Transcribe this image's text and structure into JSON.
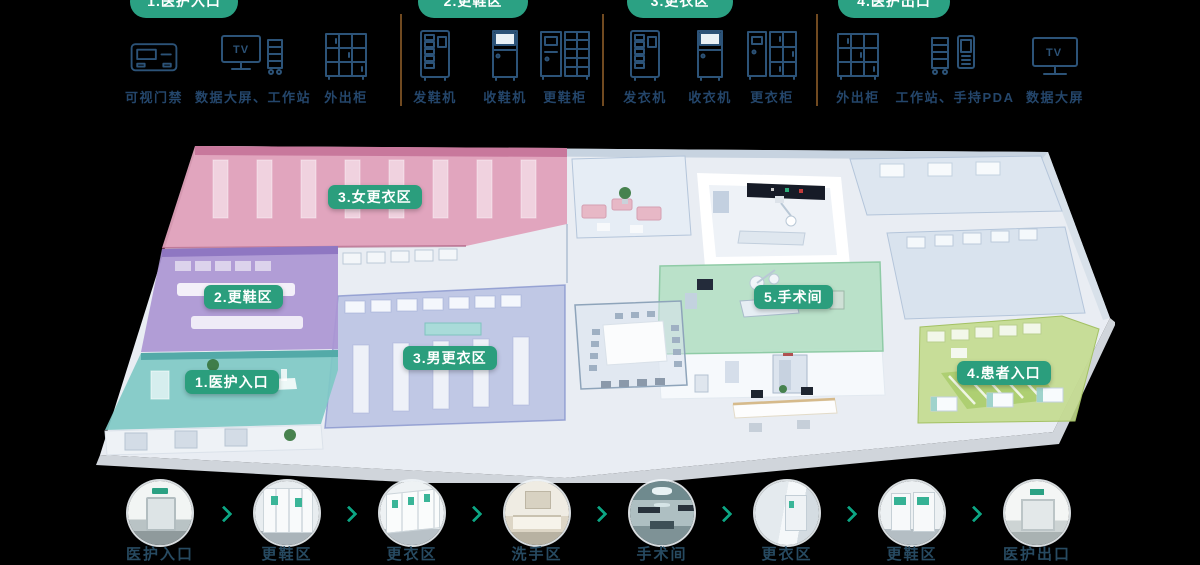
{
  "icons": {
    "tv_label": "TV"
  },
  "equipment_groups": [
    {
      "pill": "1.医护入口",
      "items": [
        {
          "label": "可视门禁"
        },
        {
          "label": "数据大屏、工作站"
        },
        {
          "label": "外出柜"
        }
      ]
    },
    {
      "pill": "2.更鞋区",
      "items": [
        {
          "label": "发鞋机"
        },
        {
          "label": "收鞋机"
        },
        {
          "label": "更鞋柜"
        }
      ]
    },
    {
      "pill": "3.更衣区",
      "items": [
        {
          "label": "发衣机"
        },
        {
          "label": "收衣机"
        },
        {
          "label": "更衣柜"
        }
      ]
    },
    {
      "pill": "4.医护出口",
      "items": [
        {
          "label": "外出柜"
        },
        {
          "label": "工作站、手持PDA"
        },
        {
          "label": "数据大屏"
        }
      ]
    }
  ],
  "floorplan": {
    "zones": [
      {
        "label": "1.医护入口"
      },
      {
        "label": "2.更鞋区"
      },
      {
        "label": "3.女更衣区"
      },
      {
        "label": "3.男更衣区"
      },
      {
        "label": "4.患者入口"
      },
      {
        "label": "5.手术间"
      }
    ]
  },
  "flow": {
    "steps": [
      {
        "label": "医护入口"
      },
      {
        "label": "更鞋区"
      },
      {
        "label": "更衣区"
      },
      {
        "label": "洗手区"
      },
      {
        "label": "手术间"
      },
      {
        "label": "更衣区"
      },
      {
        "label": "更鞋区"
      },
      {
        "label": "医护出口"
      }
    ]
  },
  "colors": {
    "brand_green": "#2ba183",
    "badge_green": "#2b9e7d",
    "arrow_green": "#0ca583",
    "icon_navy": "#2c5378",
    "label_navy": "#24466b",
    "divider_brown": "#7d5224"
  }
}
